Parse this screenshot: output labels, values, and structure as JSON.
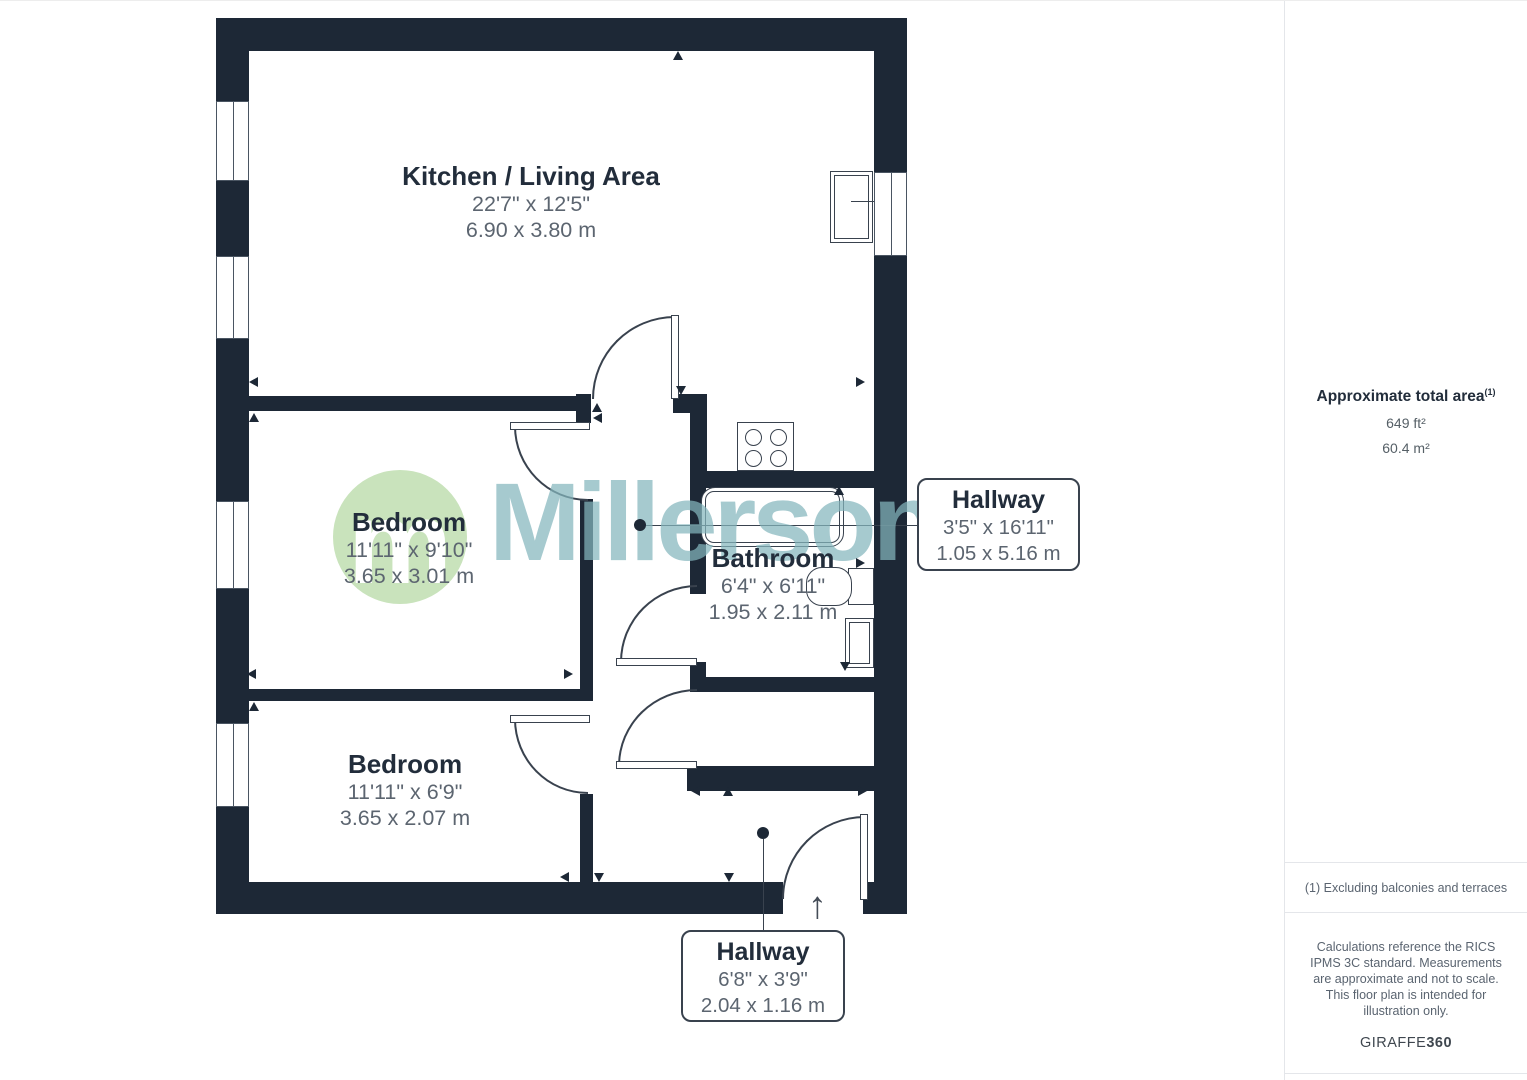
{
  "watermark": {
    "brand": "Millerson",
    "logo_letter": "m"
  },
  "icons": {
    "entrance_arrow": "↑"
  },
  "rooms": {
    "kitchen_living": {
      "name": "Kitchen / Living Area",
      "imperial": "22'7\" x 12'5\"",
      "metric": "6.90 x 3.80 m"
    },
    "bedroom1": {
      "name": "Bedroom",
      "imperial": "11'11\" x 9'10\"",
      "metric": "3.65 x 3.01 m"
    },
    "bedroom2": {
      "name": "Bedroom",
      "imperial": "11'11\" x 6'9\"",
      "metric": "3.65 x 2.07 m"
    },
    "bathroom": {
      "name": "Bathroom",
      "imperial": "6'4\" x 6'11\"",
      "metric": "1.95 x 2.11 m"
    },
    "hallway_main": {
      "name": "Hallway",
      "imperial": "3'5\" x 16'11\"",
      "metric": "1.05 x 5.16 m"
    },
    "hallway_entry": {
      "name": "Hallway",
      "imperial": "6'8\" x 3'9\"",
      "metric": "2.04 x 1.16 m"
    }
  },
  "sidebar": {
    "total_area_label": "Approximate total area",
    "total_area_footnote_ref": "(1)",
    "total_area_ft": "649 ft²",
    "total_area_m": "60.4 m²",
    "footnote": "(1) Excluding balconies and terraces",
    "disclaimer": "Calculations reference the RICS IPMS 3C standard. Measurements are approximate and not to scale. This floor plan is intended for illustration only.",
    "brand_prefix": "GIRAFFE",
    "brand_suffix": "360"
  },
  "colors": {
    "wall": "#1d2836",
    "room_name_text": "#222d3b",
    "dimension_text": "#5c6570",
    "watermark_teal": "#83b5bd",
    "logo_green": "#c9e3bc"
  }
}
